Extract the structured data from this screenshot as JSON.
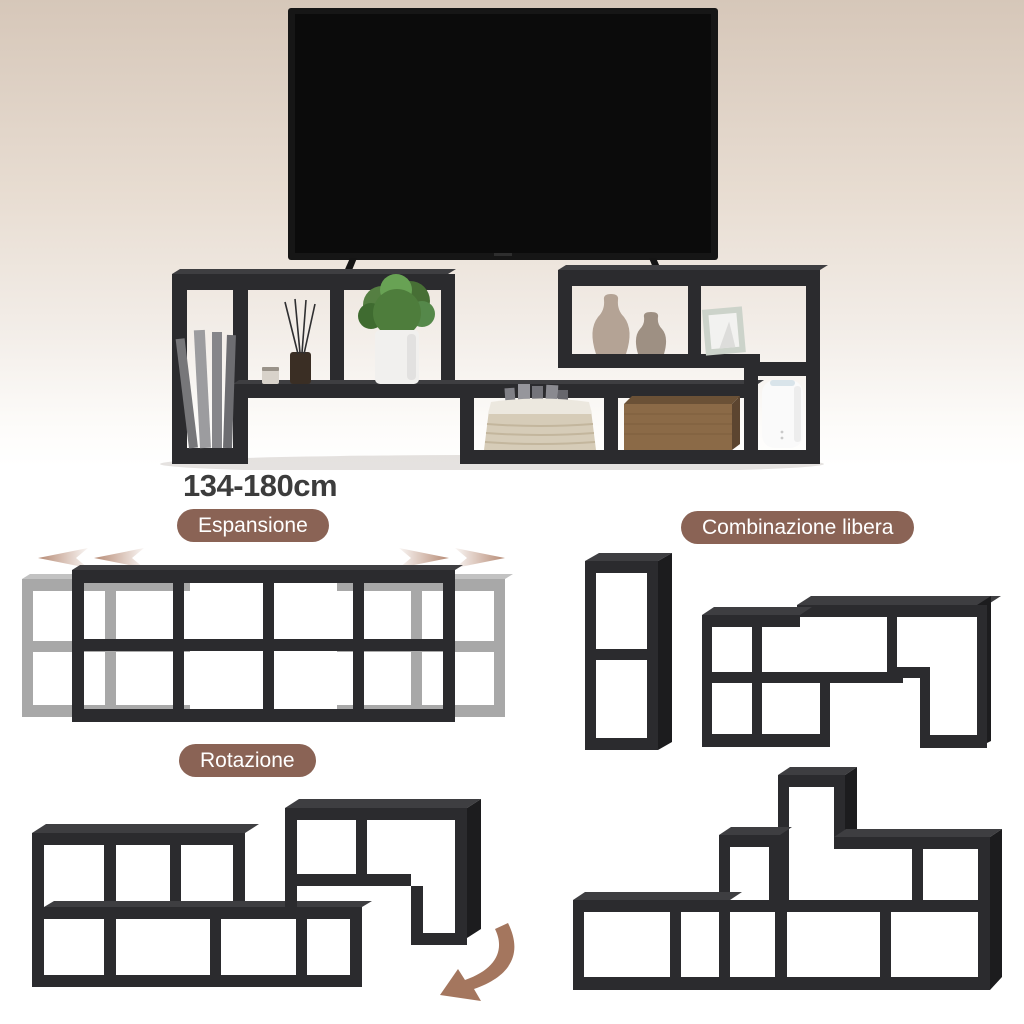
{
  "dimension_label": "134-180cm",
  "badges": {
    "expansion": {
      "label": "Espansione"
    },
    "free_combination": {
      "label": "Combinazione libera"
    },
    "rotation": {
      "label": "Rotazione"
    }
  },
  "icons": {
    "expansion_left": "expand-left-arrows-icon",
    "expansion_right": "expand-right-arrows-icon",
    "rotation": "rotate-curved-arrow-icon"
  },
  "colors": {
    "page-bg": "#ffffff",
    "scene-bg-top": "#d6c7b9",
    "scene-bg-mid": "#e8ddd2",
    "scene-bg-bottom": "#ffffff",
    "shelf-front": "#2b2b2e",
    "shelf-top": "#3e3e41",
    "shelf-side": "#1c1c1e",
    "ghost-front": "#a8a8a8",
    "ghost-top": "#c2c2c2",
    "badge-bg": "#8a6355",
    "badge-text": "#ffffff",
    "dimension-text": "#3c3c3c",
    "arrow-brown": "#b68a74",
    "rotation-arrow": "#a4765e",
    "tv-bezel": "#161616",
    "tv-screen": "#0b0b0b"
  }
}
